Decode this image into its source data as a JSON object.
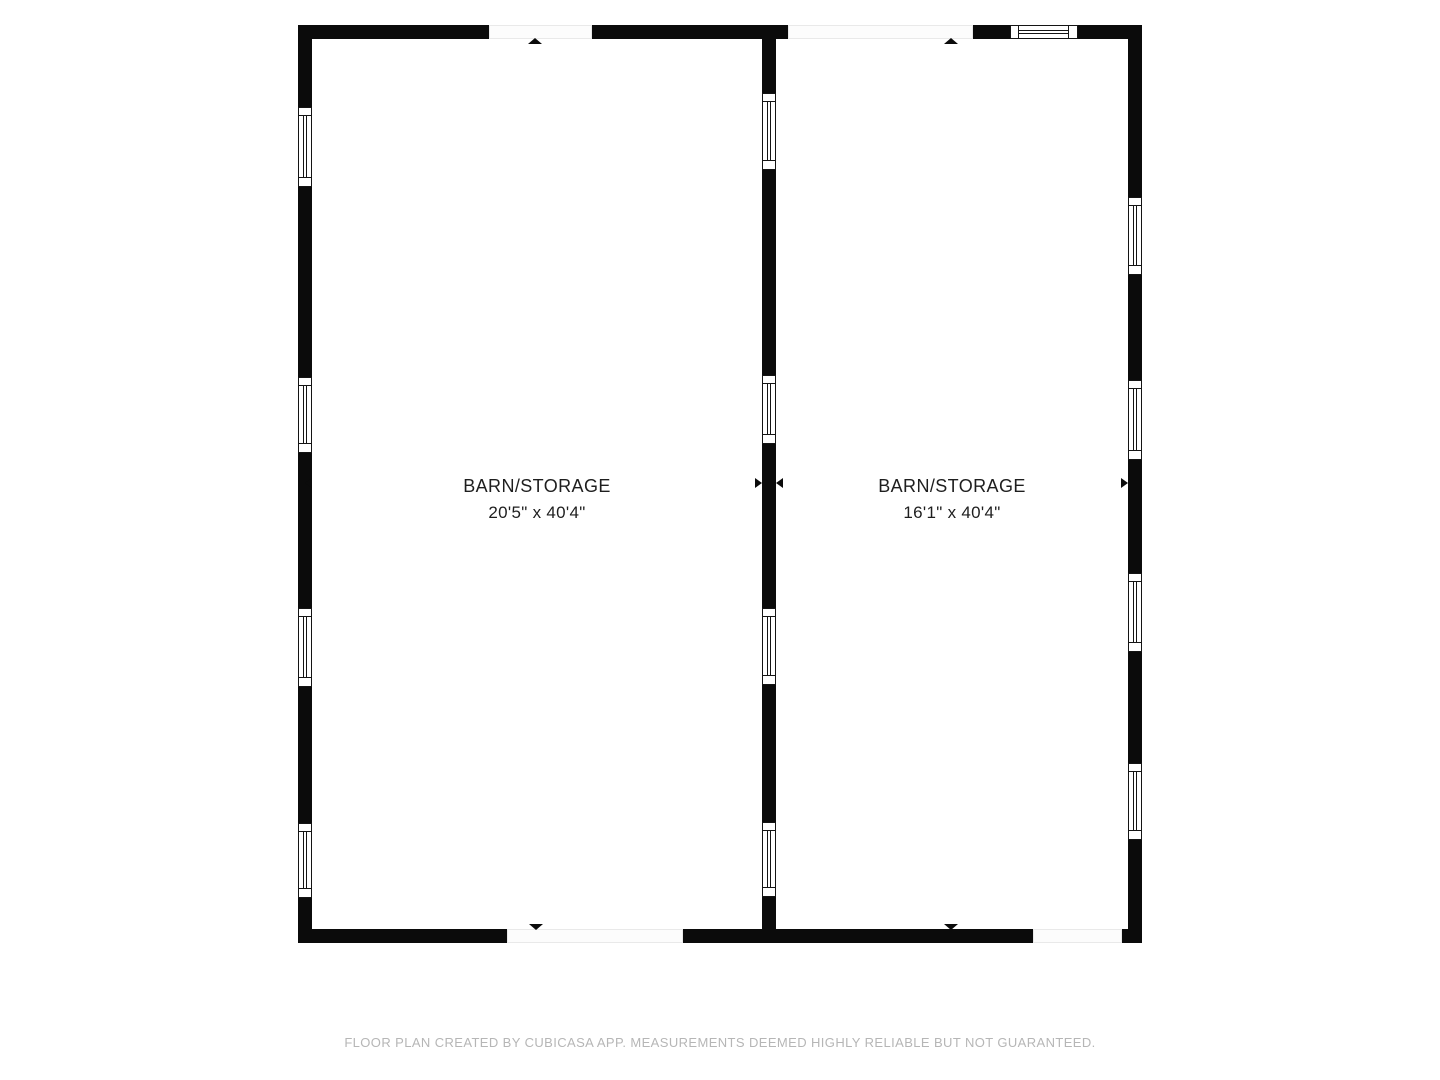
{
  "rooms": [
    {
      "name": "BARN/STORAGE",
      "dimensions": "20'5\" x 40'4\""
    },
    {
      "name": "BARN/STORAGE",
      "dimensions": "16'1\" x 40'4\""
    }
  ],
  "footer": {
    "disclaimer": "FLOOR PLAN CREATED BY CUBICASA APP. MEASUREMENTS DEEMED HIGHLY RELIABLE BUT NOT GUARANTEED."
  },
  "colors": {
    "wall": "#0b0b0b",
    "background": "#ffffff",
    "label_text": "#1e1e1e",
    "footer_text": "#b6b6b6",
    "opening_fill": "#fcfcfc",
    "opening_border": "#e9e9e9"
  }
}
